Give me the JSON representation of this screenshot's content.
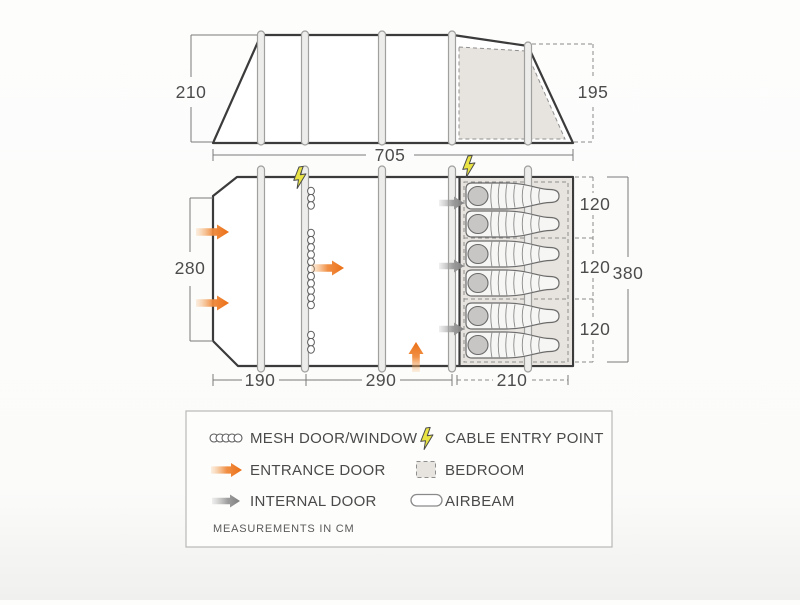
{
  "side_view": {
    "peak_height_cm": "210",
    "rear_height_cm": "195",
    "length_cm": "705"
  },
  "floor_plan": {
    "front_width_cm": "280",
    "front_section_cm": "190",
    "living_section_cm": "290",
    "bedroom_section_cm": "210",
    "bedroom_total_depth_cm": "380",
    "bedroom_compartment_1_cm": "120",
    "bedroom_compartment_2_cm": "120",
    "bedroom_compartment_3_cm": "120",
    "sleeping_bag_count": 6,
    "airbeam_count": 5,
    "entrance_door_count": 4,
    "internal_door_count": 3,
    "cable_entry_count": 2,
    "mesh_strip_count": 3
  },
  "legend": {
    "items": [
      {
        "icon": "mesh-chain-icon",
        "label": "MESH DOOR/WINDOW"
      },
      {
        "icon": "entrance-arrow-icon",
        "label": "ENTRANCE DOOR"
      },
      {
        "icon": "internal-arrow-icon",
        "label": "INTERNAL DOOR"
      },
      {
        "icon": "cable-bolt-icon",
        "label": "CABLE ENTRY POINT"
      },
      {
        "icon": "bedroom-swatch-icon",
        "label": "BEDROOM"
      },
      {
        "icon": "airbeam-capsule-icon",
        "label": "AIRBEAM"
      }
    ],
    "note": "MEASUREMENTS IN CM"
  },
  "colors": {
    "accent_orange": "#ea6f15",
    "accent_orange_light": "#f5b777",
    "internal_gray": "#7f7f7f",
    "internal_gray_light": "#b5b5b5",
    "bolt_yellow": "#e9e443",
    "bedroom_fill": "#e7e3de",
    "beam_fill": "#ededec",
    "beam_stroke": "#a0a09e",
    "outline_dark": "#3b3b3b",
    "bag_fill": "#f6f6f5",
    "bag_stroke": "#6b6b6b",
    "pillow_fill": "#c7c6c4"
  }
}
